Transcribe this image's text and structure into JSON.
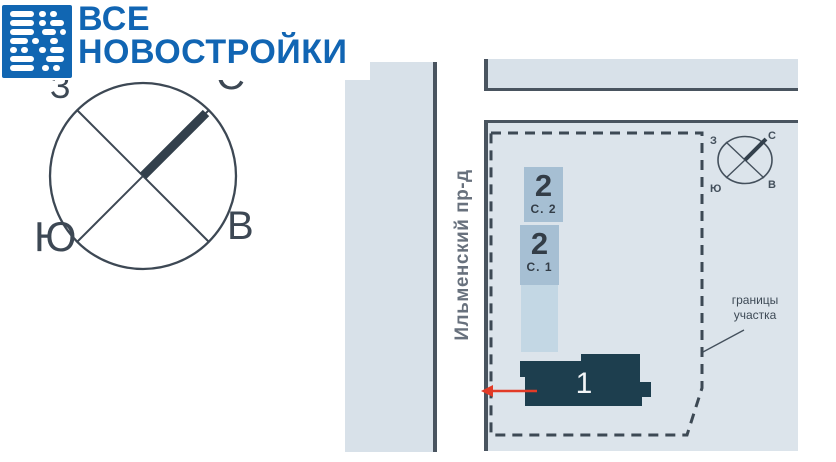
{
  "logo": {
    "line1": "ВСЕ",
    "line2": "НОВОСТРОЙКИ",
    "icon_name": "brand-morse-grid-icon",
    "brand_color": "#1165b3"
  },
  "site_plan": {
    "street_name": "Ильменский пр-д",
    "boundary_label": "границы\nучастка",
    "buildings": [
      {
        "number": "2",
        "label": "С. 2"
      },
      {
        "number": "2",
        "label": "С. 1"
      },
      {
        "number": "1",
        "label": ""
      }
    ],
    "compass": {
      "north": "С",
      "south": "Ю",
      "west": "З",
      "east": "В"
    },
    "colors": {
      "street_fill": "#d8e1e9",
      "site_fill": "#dce4eb",
      "building_blue": "#a6bfd3",
      "building_light": "#c3d7e4",
      "building_dark": "#1d3e4e",
      "outline_dark": "#49545f",
      "dash_color": "#3d4954",
      "arrow_red": "#e23b27"
    }
  }
}
